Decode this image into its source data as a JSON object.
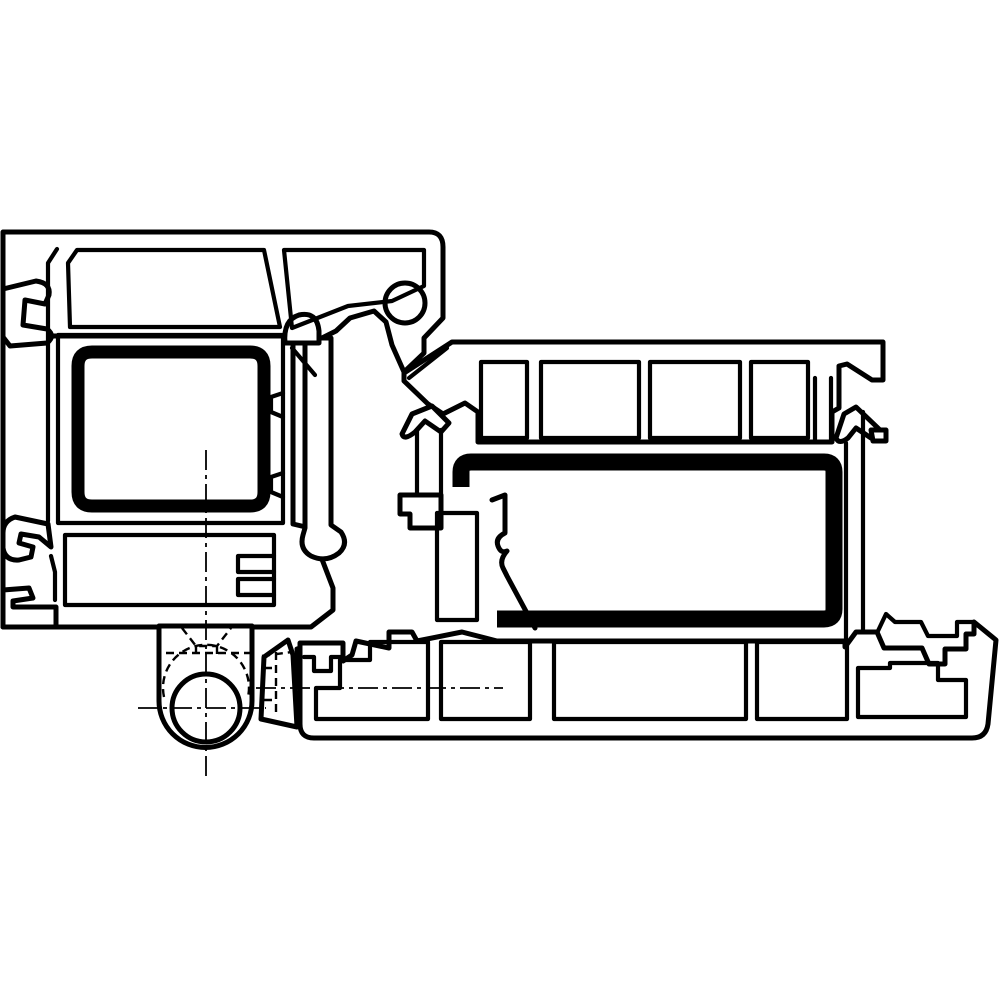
{
  "meta": {
    "domain": "technical-diagram",
    "description": "Black-and-white technical cross-section drawing of two interlocking PVC window/door profiles (frame and sash) with thick black steel reinforcement inserts, a hinge knuckle with pin bore at the lower left, dash-dot centerlines and dashed hidden edges. No text labels.",
    "background_color": "#ffffff",
    "line_color": "#000000",
    "parts": [
      "frame-profile-left",
      "frame-steel-reinforcement",
      "frame-clip-hooks",
      "glazing-gasket-bump",
      "frame-glazing-leg",
      "hinge-body",
      "hinge-knuckle-bore",
      "hinge-sash-arm",
      "sash-profile-right",
      "sash-steel-reinforcement",
      "sash-seal-arrows",
      "sash-bottom-chambers",
      "sill-clip-hooks",
      "centerlines",
      "hidden-edges"
    ]
  },
  "drawing": {
    "viewbox": "0 0 1000 1000",
    "width": 1000,
    "height": 1000,
    "shapes": [
      {
        "name": "frame-top-band",
        "cls": "outline",
        "d": "M3 232 L429 232 Q443 232 443 247 L443 318 L424 338 L424 353 L404 372 L392 345 L386 322 L374 311 L350 318 L336 331 L318 340 L298 340 L284 346 L258 340 L3 340 Z"
      },
      {
        "name": "frame-body",
        "cls": "outline",
        "d": "M3 336 L293 336 L293 524 L310 528 L333 588 L333 610 L311 627 L3 627 Z"
      },
      {
        "name": "frame-glazing-leg",
        "cls": "outline",
        "d": "M301 338 L331 338 L331 525 L341 532 Q349 544 339 553 Q326 563 311 556 Q299 549 303 535 L305 528 L305 338 Z"
      },
      {
        "name": "glazing-gasket-bump",
        "cls": "outline",
        "circle": [
          405,
          303,
          20
        ]
      },
      {
        "name": "gasket-hump",
        "cls": "outline",
        "d": "M285 343 Q283 320 299 315 Q317 311 319 331 L319 343 Z"
      },
      {
        "name": "frame-hook-top",
        "cls": "outline",
        "d": "M3 289 L36 281 Q51 283 49 295 L45 304 L25 300 L23 325 L47 329 Q56 336 47 343 L10 346 L3 337 Z"
      },
      {
        "name": "frame-hook-middle",
        "cls": "outline",
        "d": "M48 524 L15 517 Q3 521 3 533 L3 548 Q5 561 19 560 L31 557 L33 547 L19 543 L21 534 L39 537 L51 547 Z"
      },
      {
        "name": "frame-hook-bottom",
        "cls": "outline",
        "d": "M3 590 L29 588 L33 598 L13 601 L13 607 L56 607 L56 627 L3 627 Z"
      },
      {
        "name": "frame-cell-top-1",
        "cls": "thin",
        "d": "M77 250 L264 250 L280 327 L70 327 L68 263 Z"
      },
      {
        "name": "frame-cell-top-2",
        "cls": "thin",
        "d": "M284 250 L424 250 L424 286 L392 301 L348 306 L292 328 Z"
      },
      {
        "name": "frame-wall-inner",
        "cls": "thin",
        "d": "M57 249 L48 263 L48 521 M51 556 L55 572 L55 600"
      },
      {
        "name": "frame-cell-reinforcement",
        "cls": "thin",
        "d": "M58 335 L283 335 L283 523 L58 523 Z"
      },
      {
        "name": "frame-tongue-1",
        "cls": "thin",
        "d": "M283 393 L271 397 L271 412 L283 417"
      },
      {
        "name": "frame-tongue-2",
        "cls": "thin",
        "d": "M283 473 L271 477 L271 492 L283 497"
      },
      {
        "name": "frame-cell-bottom",
        "cls": "thin",
        "d": "M65 535 L274 535 L274 605 L65 605 Z"
      },
      {
        "name": "frame-seal-teeth",
        "cls": "thin",
        "d": "M274 556 L238 556 L238 572 L274 572 M274 579 L238 579 L238 595 L274 595"
      },
      {
        "name": "frame-glazing-slope",
        "cls": "thin",
        "d": "M292 348 L315 375"
      },
      {
        "name": "frame-steel-reinforcement",
        "cls": "black13",
        "d": "M92 352 L250 352 Q264 352 264 366 L264 492 Q264 506 250 506 L92 506 Q78 506 78 492 L78 366 Q78 352 92 352 Z"
      },
      {
        "name": "hinge-body",
        "cls": "outline",
        "d": "M159 626 L159 701 A46.5 46.5 0 0 0 252 701 L252 626 Z"
      },
      {
        "name": "hinge-knuckle-bore",
        "cls": "outline",
        "circle": [
          206,
          708,
          34
        ]
      },
      {
        "name": "hinge-sash-arm",
        "cls": "outline",
        "d": "M288 640 L264 657 L261 719 L297 727 L293 655 Z"
      },
      {
        "name": "hinge-arm-link",
        "cls": "outline",
        "d": "M297 649 L317 643 L317 679 L299 688 Z"
      },
      {
        "name": "hinge-hidden-countersink",
        "cls": "hidden",
        "d": "M182 628 L196 646 L217 646 L231 628 M196 646 L196 659 M217 646 L217 659"
      },
      {
        "name": "hinge-hidden-lines",
        "cls": "hidden",
        "d": "M166 653 L250 653 M262 656 L292 652 M276 652 L276 716 M264 668 L276 668 M264 700 L276 700"
      },
      {
        "name": "hinge-hidden-arc",
        "cls": "hidden",
        "d": "M164 697 A43 43 0 1 1 248 697"
      },
      {
        "name": "sash-top-band",
        "cls": "outline",
        "d": "M452 342 L883 342 L883 380 L872 380 L847 364 L839 366 L839 408 L832 412 L832 442 L478 442 L478 412 L465 403 L443 414 L428 404 L404 381 L404 373 Z"
      },
      {
        "name": "sash-corner-slope",
        "cls": "thin",
        "d": "M447 348 L409 378"
      },
      {
        "name": "sash-cell-1",
        "cls": "thin",
        "d": "M481 362 L527 362 L527 438 L481 438 Z"
      },
      {
        "name": "sash-cell-2",
        "cls": "thin",
        "d": "M541 362 L639 362 L639 438 L541 438 Z"
      },
      {
        "name": "sash-cell-3",
        "cls": "thin",
        "d": "M650 362 L740 362 L740 438 L650 438 Z"
      },
      {
        "name": "sash-cell-4",
        "cls": "thin",
        "d": "M751 362 L808 362 L808 438 L751 438 Z"
      },
      {
        "name": "sash-t-stem",
        "cls": "thin",
        "d": "M815 442 L815 378 M831 442 L831 378"
      },
      {
        "name": "sash-corner-arrow-seal",
        "cls": "outline",
        "d": "M856 407 L879 429 L871 438 L856 428 L848 438 Q839 445 836 438 L844 414 Z"
      },
      {
        "name": "sash-corner-hook",
        "cls": "outline",
        "d": "M871 430 L886 430 L886 441 L873 441 Z"
      },
      {
        "name": "sash-arrow-seal",
        "cls": "outline",
        "d": "M432 406 L449 423 L441 432 L425 421 L415 432 Q404 441 402 434 L412 414 Z"
      },
      {
        "name": "sash-seal-shaft",
        "cls": "thin",
        "d": "M417 430 L417 495 M441 430 L441 495"
      },
      {
        "name": "sash-seal-foot",
        "cls": "outline",
        "d": "M400 495 L441 495 L441 528 L410 528 L410 514 L400 514 Z"
      },
      {
        "name": "sash-inner-cell",
        "cls": "thin",
        "d": "M437 513 L477 513 L477 620 L437 620 Z"
      },
      {
        "name": "sash-wall-low",
        "cls": "edge",
        "d": "M492 500 L505 495 L505 533 Q495 538 498 546 Q501 554 507 551 Q499 560 503 568 L507 576 L535 628"
      },
      {
        "name": "sash-steel-reinforcement",
        "cls": "black17",
        "d": "M461 487 L461 472 Q461 462 471 462 L824 462 Q834 462 834 472 L834 609 Q834 619 824 619 L497 619"
      },
      {
        "name": "sash-wall-right",
        "cls": "thin",
        "d": "M846 443 L846 640 M863 412 L863 645"
      },
      {
        "name": "sash-bottom-band",
        "cls": "outline",
        "d": "M300 643 L343 643 L343 661 L352 655 L356 641 L389 648 L389 632 L412 632 L417 641 L462 632 L497 641 L845 641 L845 647 L856 632 L877 632 L884 648 L922 648 L929 664 L945 664 L945 649 L966 649 L966 634 L974 634 L974 622 L996 640 L988 724 Q986 738 972 738 L314 738 Q300 738 300 724 Z"
      },
      {
        "name": "sash-band-notch",
        "cls": "thin",
        "d": "M304 657 L314 657 L314 671 L331 671 L331 657 L341 657"
      },
      {
        "name": "sash-band-cell-a",
        "cls": "thin",
        "d": "M316 688 L316 719 L428 719 L428 642 L370 642 L370 660 L340 660 L340 688 Z"
      },
      {
        "name": "sash-band-cell-b",
        "cls": "thin",
        "d": "M441 642 L530 642 L530 719 L441 719 Z"
      },
      {
        "name": "sash-band-cell-c",
        "cls": "thin",
        "d": "M554 642 L746 642 L746 719 L554 719 Z"
      },
      {
        "name": "sash-band-cell-d",
        "cls": "thin",
        "d": "M757 642 L847 642 L847 719 L757 719 Z"
      },
      {
        "name": "sash-band-cell-e",
        "cls": "thin",
        "d": "M858 668 L858 717 L966 717 L966 680 L938 680 L938 663 L890 663 L890 668 Z"
      },
      {
        "name": "sill-clip-hook",
        "cls": "thin",
        "d": "M877 633 L886 614 L895 622 L921 622 L928 636 L957 636 L957 622 L973 622"
      },
      {
        "name": "centerline-vertical",
        "cls": "center",
        "d": "M206 450 L206 777"
      },
      {
        "name": "centerline-hinge-pin",
        "cls": "center",
        "d": "M138 708 L266 708"
      },
      {
        "name": "centerline-hinge-arm",
        "cls": "center",
        "d": "M256 688 L503 688"
      }
    ]
  }
}
